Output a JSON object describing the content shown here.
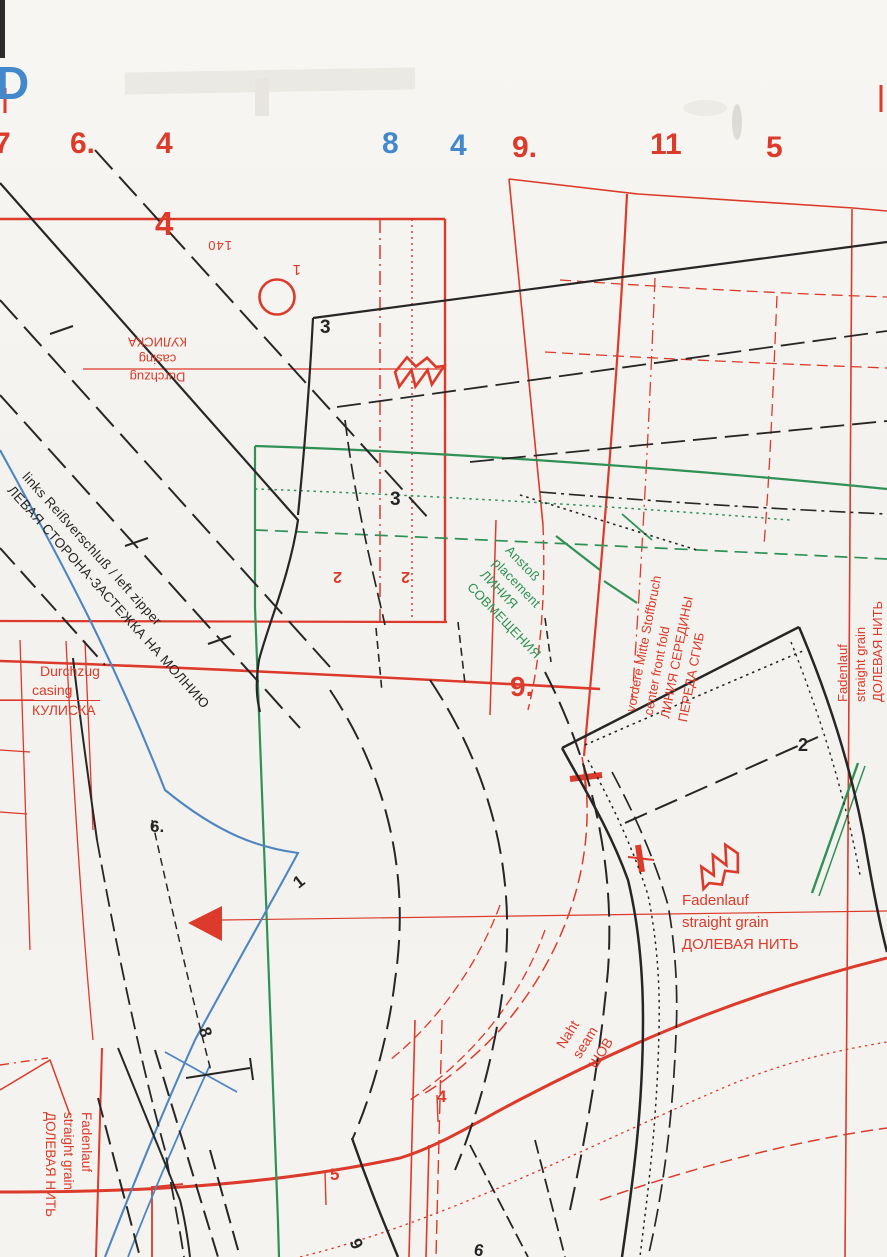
{
  "colors": {
    "red": "#dc3a2a",
    "blue_numbers": "#4488cc",
    "green": "#2f9156",
    "blue_line": "#4f86c0",
    "black": "#262626",
    "paper": "#f5f3ef"
  },
  "corner_letter": "D",
  "top_numbers": [
    {
      "text": "7",
      "color": "red"
    },
    {
      "text": "6.",
      "color": "red"
    },
    {
      "text": "4",
      "color": "red"
    },
    {
      "text": "8",
      "color": "blue"
    },
    {
      "text": "4",
      "color": "blue"
    },
    {
      "text": "9.",
      "color": "red"
    },
    {
      "text": "11",
      "color": "red"
    },
    {
      "text": "5",
      "color": "red"
    }
  ],
  "piece_labels": {
    "big_four": "4",
    "three_a": "3",
    "three_b": "3",
    "two_red_a": "2",
    "two_red_b": "2",
    "nine_dot": "9.",
    "two_black": "2",
    "six_dot": "6.",
    "one": "1",
    "eight": "8",
    "four_small": "4",
    "five_small": "5",
    "nine_bottom": "9",
    "six_bottom": "6"
  },
  "size_mark": {
    "number": "140",
    "index": "1"
  },
  "texts": {
    "casing_top": {
      "lines": [
        "Durchzug",
        "casing",
        "КУЛИСКА"
      ]
    },
    "zipper": {
      "lines": [
        "links Reißverschluß / left zipper",
        "ЛЕВАЯ СТОРОНА-ЗАСТЕЖКА НА МОЛНИЮ"
      ]
    },
    "casing_left": {
      "lines": [
        "Durchzug",
        "casing",
        "КУЛИСКА"
      ]
    },
    "placement": {
      "lines": [
        "Anstoß",
        "placement",
        "ЛИНИЯ",
        "СОВМЕЩЕНИЯ"
      ]
    },
    "center_front": {
      "lines": [
        "vordere Mitte Stoffbruch",
        "center front fold",
        "ЛИНИЯ СЕРЕДИНЫ",
        "ПЕРЕДА СГИБ"
      ]
    },
    "grain_right": {
      "lines": [
        "Fadenlauf",
        "straight grain",
        "ДОЛЕВАЯ НИТЬ"
      ]
    },
    "grain_mid": {
      "lines": [
        "Fadenlauf",
        "straight grain",
        "ДОЛЕВАЯ НИТЬ"
      ]
    },
    "seam": {
      "lines": [
        "Naht",
        "seam",
        "ШОВ"
      ]
    },
    "grain_bottom_left": {
      "lines": [
        "Fadenlauf",
        "straight grain",
        "ДОЛЕВАЯ НИТЬ"
      ]
    }
  }
}
